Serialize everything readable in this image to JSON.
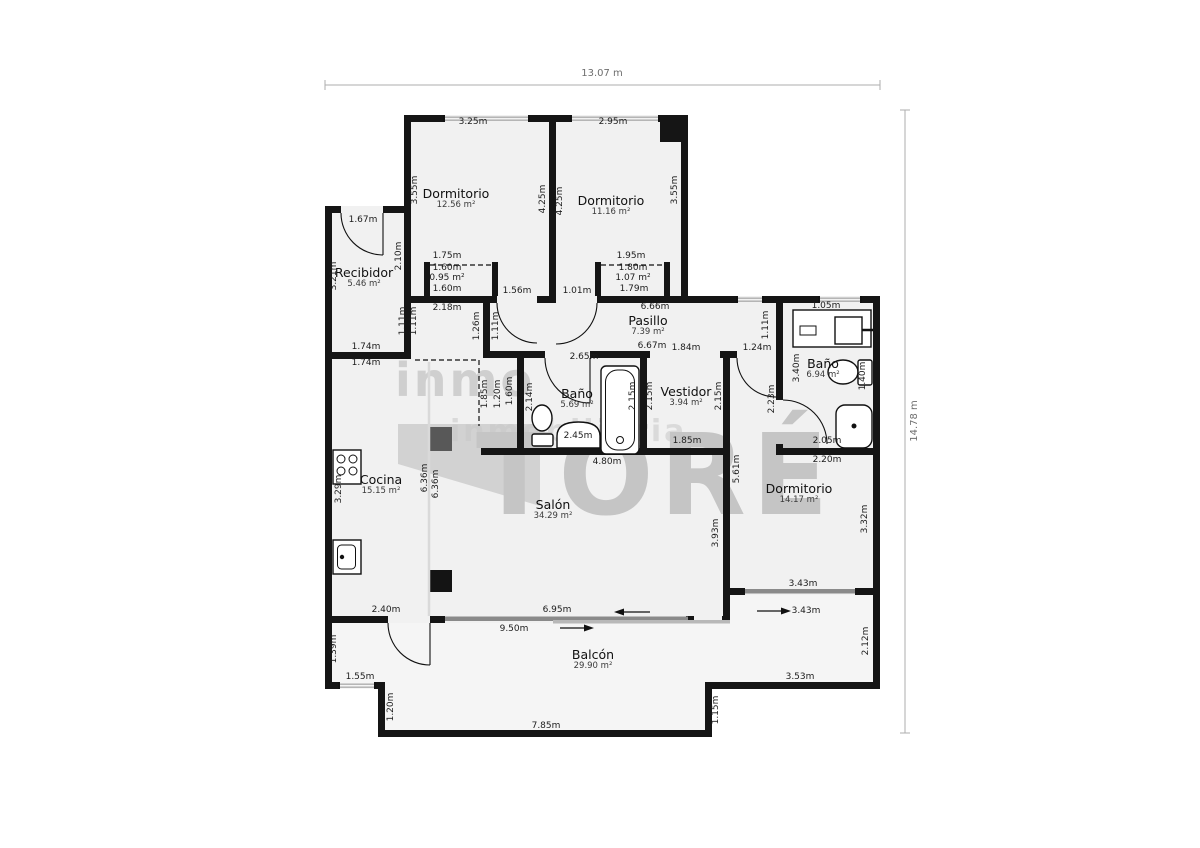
{
  "plan": {
    "overall_width_label": "13.07 m",
    "overall_height_label": "14.78 m"
  },
  "watermark": {
    "brand_top": "inmo",
    "brand_main": "TORÉ",
    "brand_sub": "inmobiliaria"
  },
  "colors": {
    "wall": "#151515",
    "floor": "#f1f1f1",
    "balcony": "#f5f5f5",
    "watermark-gray": "#c9c9c9"
  },
  "rooms": [
    {
      "name": "Dormitorio",
      "area": "12.56 m²",
      "x": 456,
      "y": 199
    },
    {
      "name": "Dormitorio",
      "area": "11.16 m²",
      "x": 611,
      "y": 206
    },
    {
      "name": "Recibidor",
      "area": "5.46 m²",
      "x": 364,
      "y": 278
    },
    {
      "name": "Pasillo",
      "area": "7.39 m²",
      "x": 648,
      "y": 326
    },
    {
      "name": "Baño",
      "area": "5.69 m²",
      "x": 577,
      "y": 399
    },
    {
      "name": "Vestidor",
      "area": "3.94 m²",
      "x": 686,
      "y": 397
    },
    {
      "name": "Baño",
      "area": "6.94 m²",
      "x": 823,
      "y": 369
    },
    {
      "name": "Cocina",
      "area": "15.15 m²",
      "x": 381,
      "y": 485
    },
    {
      "name": "Salón",
      "area": "34.29 m²",
      "x": 553,
      "y": 510
    },
    {
      "name": "Dormitorio",
      "area": "14.17 m²",
      "x": 799,
      "y": 494
    },
    {
      "name": "Balcón",
      "area": "29.90 m²",
      "x": 593,
      "y": 660
    }
  ],
  "dims": [
    {
      "t": "3.25m",
      "x": 473,
      "y": 122
    },
    {
      "t": "2.95m",
      "x": 613,
      "y": 122
    },
    {
      "t": "3.55m",
      "x": 415,
      "y": 190,
      "r": 1
    },
    {
      "t": "4.25m",
      "x": 543,
      "y": 199,
      "r": 1
    },
    {
      "t": "4.25m",
      "x": 560,
      "y": 201,
      "r": 1
    },
    {
      "t": "3.55m",
      "x": 675,
      "y": 190,
      "r": 1
    },
    {
      "t": "1.75m",
      "x": 447,
      "y": 256
    },
    {
      "t": "1.60m",
      "x": 447,
      "y": 268
    },
    {
      "t": "0.95 m²",
      "x": 447,
      "y": 278
    },
    {
      "t": "1.60m",
      "x": 447,
      "y": 289
    },
    {
      "t": "1.95m",
      "x": 631,
      "y": 256
    },
    {
      "t": "1.80m",
      "x": 633,
      "y": 268
    },
    {
      "t": "1.07 m²",
      "x": 633,
      "y": 278
    },
    {
      "t": "1.79m",
      "x": 634,
      "y": 289
    },
    {
      "t": "1.56m",
      "x": 517,
      "y": 291
    },
    {
      "t": "1.01m",
      "x": 577,
      "y": 291
    },
    {
      "t": "1.67m",
      "x": 363,
      "y": 220
    },
    {
      "t": "3.21m",
      "x": 334,
      "y": 276,
      "r": 1
    },
    {
      "t": "2.10m",
      "x": 399,
      "y": 256,
      "r": 1
    },
    {
      "t": "1.74m",
      "x": 366,
      "y": 347
    },
    {
      "t": "1.74m",
      "x": 366,
      "y": 363
    },
    {
      "t": "2.18m",
      "x": 447,
      "y": 308
    },
    {
      "t": "1.11m",
      "x": 403,
      "y": 321,
      "r": 1
    },
    {
      "t": "1.11m",
      "x": 414,
      "y": 321,
      "r": 1
    },
    {
      "t": "1.26m",
      "x": 477,
      "y": 326,
      "r": 1
    },
    {
      "t": "1.11m",
      "x": 496,
      "y": 326,
      "r": 1
    },
    {
      "t": "6.66m",
      "x": 655,
      "y": 307
    },
    {
      "t": "6.67m",
      "x": 652,
      "y": 346
    },
    {
      "t": "1.11m",
      "x": 766,
      "y": 325,
      "r": 1
    },
    {
      "t": "2.65m",
      "x": 584,
      "y": 357
    },
    {
      "t": "2.14m",
      "x": 530,
      "y": 397,
      "r": 1
    },
    {
      "t": "2.45m",
      "x": 578,
      "y": 436
    },
    {
      "t": "1.85m",
      "x": 485,
      "y": 394,
      "r": 1
    },
    {
      "t": "1.20m",
      "x": 498,
      "y": 394,
      "r": 1
    },
    {
      "t": "1.60m",
      "x": 510,
      "y": 391,
      "r": 1
    },
    {
      "t": "4.80m",
      "x": 607,
      "y": 462
    },
    {
      "t": "1.84m",
      "x": 686,
      "y": 348
    },
    {
      "t": "2.15m",
      "x": 633,
      "y": 396,
      "r": 1
    },
    {
      "t": "2.15m",
      "x": 650,
      "y": 396,
      "r": 1
    },
    {
      "t": "2.15m",
      "x": 719,
      "y": 396,
      "r": 1
    },
    {
      "t": "1.85m",
      "x": 687,
      "y": 441
    },
    {
      "t": "1.24m",
      "x": 757,
      "y": 348
    },
    {
      "t": "2.23m",
      "x": 772,
      "y": 399,
      "r": 1
    },
    {
      "t": "1.05m",
      "x": 826,
      "y": 306
    },
    {
      "t": "3.40m",
      "x": 797,
      "y": 368,
      "r": 1
    },
    {
      "t": "1.40m",
      "x": 863,
      "y": 376,
      "r": 1
    },
    {
      "t": "2.05m",
      "x": 827,
      "y": 441
    },
    {
      "t": "2.20m",
      "x": 827,
      "y": 460
    },
    {
      "t": "5.61m",
      "x": 737,
      "y": 469,
      "r": 1
    },
    {
      "t": "3.32m",
      "x": 865,
      "y": 519,
      "r": 1
    },
    {
      "t": "3.43m",
      "x": 803,
      "y": 584
    },
    {
      "t": "3.43m",
      "x": 806,
      "y": 611
    },
    {
      "t": "3.93m",
      "x": 716,
      "y": 533,
      "r": 1
    },
    {
      "t": "2.40m",
      "x": 386,
      "y": 610
    },
    {
      "t": "6.95m",
      "x": 557,
      "y": 610
    },
    {
      "t": "9.50m",
      "x": 514,
      "y": 629
    },
    {
      "t": "3.29m",
      "x": 339,
      "y": 489,
      "r": 1
    },
    {
      "t": "6.36m",
      "x": 425,
      "y": 478,
      "r": 1
    },
    {
      "t": "6.36m",
      "x": 436,
      "y": 484,
      "r": 1
    },
    {
      "t": "1.39m",
      "x": 334,
      "y": 649,
      "r": 1
    },
    {
      "t": "1.55m",
      "x": 360,
      "y": 677
    },
    {
      "t": "1.20m",
      "x": 391,
      "y": 707,
      "r": 1
    },
    {
      "t": "7.85m",
      "x": 546,
      "y": 726
    },
    {
      "t": "1.15m",
      "x": 716,
      "y": 710,
      "r": 1
    },
    {
      "t": "3.53m",
      "x": 800,
      "y": 677
    },
    {
      "t": "2.12m",
      "x": 866,
      "y": 641,
      "r": 1
    }
  ]
}
